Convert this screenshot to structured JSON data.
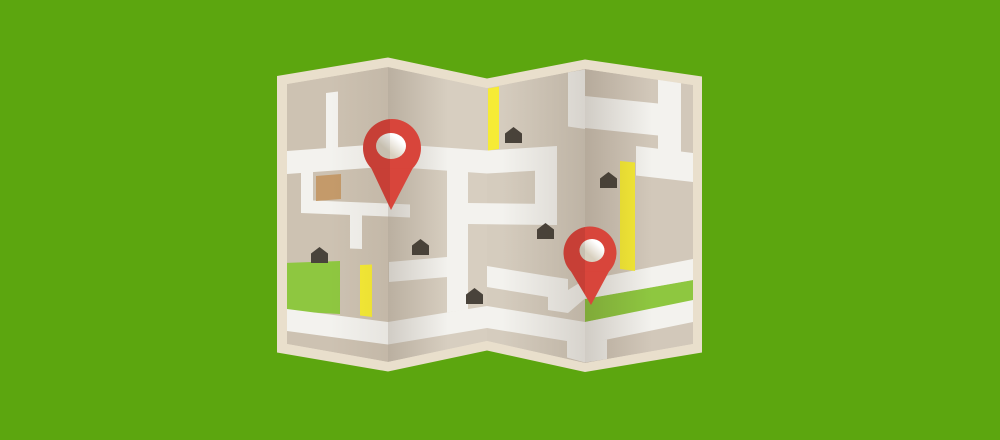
{
  "scene": {
    "name": "folded-map-illustration",
    "kind": "flat vector illustration",
    "background": "solid green",
    "panels": 4,
    "pin_count": 2,
    "house_count": 6,
    "park_count": 2
  },
  "palette": {
    "background_green": "#5ca60f",
    "paper_cream": "#e9dfcc",
    "panel_1": "#cdc2b2",
    "panel_2": "#d7cec0",
    "panel_3": "#d5ccbe",
    "panel_4": "#d2c8ba",
    "road_white": "#f3f2ee",
    "road_yellow": "#f6eb35",
    "park_green": "#8ec740",
    "pin_red": "#d8453b",
    "house_gray": "#49433b",
    "building_brown": "#c49a6a"
  },
  "pins": [
    {
      "id": "pin-1",
      "x": 392,
      "y": 148
    },
    {
      "id": "pin-2",
      "x": 590,
      "y": 253
    }
  ],
  "houses": [
    {
      "x": 311,
      "y": 247
    },
    {
      "x": 412,
      "y": 239
    },
    {
      "x": 466,
      "y": 288
    },
    {
      "x": 505,
      "y": 127
    },
    {
      "x": 537,
      "y": 223
    },
    {
      "x": 600,
      "y": 172
    }
  ]
}
